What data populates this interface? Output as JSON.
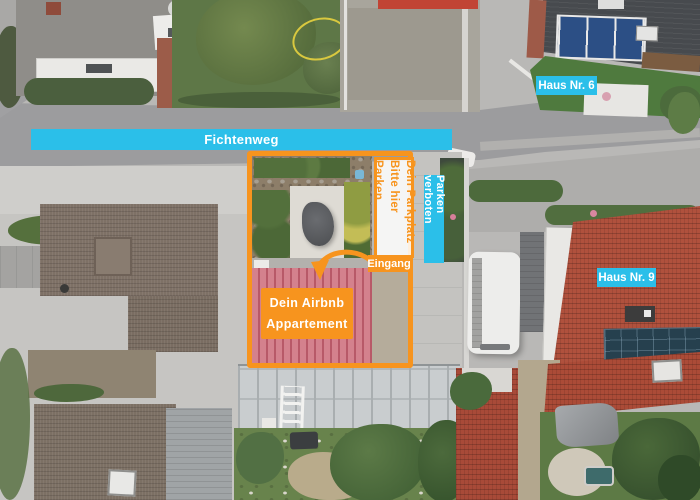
{
  "scene": {
    "street_banner": "Fichtenweg",
    "house_labels": {
      "haus6": "Haus Nr. 6",
      "haus9": "Haus Nr. 9"
    },
    "parking_note": {
      "line1": "Dein Parkplatz",
      "line2": "Bitte hier Parken"
    },
    "no_parking_note": "Parken verboten",
    "entrance_label": "Eingang",
    "apartment_label": {
      "line1": "Dein Airbnb",
      "line2": "Appartement"
    },
    "colors": {
      "cyan": "#2bbfe9",
      "orange": "#f7941e",
      "roof-highlight": "#d4818d"
    }
  }
}
